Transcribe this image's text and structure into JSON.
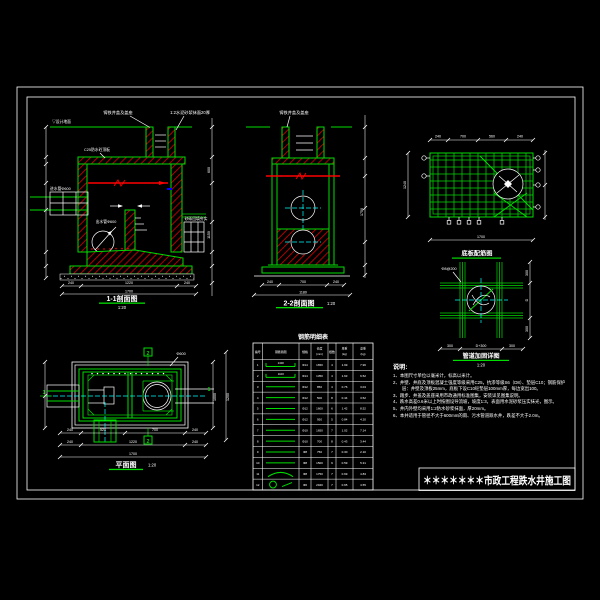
{
  "sheet": {
    "background": "#000000",
    "frame_color": "#ffffff",
    "line_green": "#00dd00",
    "line_red": "#ff0000",
    "line_cyan": "#00ffff",
    "accent_blue": "#0000ff"
  },
  "title_block": {
    "title": "＊＊＊＊＊＊＊市政工程跌水井施工图"
  },
  "views": {
    "section11": {
      "label": "1-1剖面图",
      "scale": "1:20",
      "ann_cover": "铸铁井盖及盖座",
      "ann_plaster": "1:2水泥砂浆抹面20厚",
      "ann_slab": "C25防水砼顶板",
      "ann_ground": "▽设计地面",
      "ann_inlet": "进水管Φ600",
      "ann_outlet": "出水管Φ600",
      "ann_backfill": "砂砾回填夯实",
      "dims_bottom": [
        "240",
        "1220",
        "240"
      ],
      "dim_overall": "1700",
      "dims_right": [
        "600",
        "1150"
      ]
    },
    "section22": {
      "label": "2-2剖面图",
      "scale": "1:20",
      "ann_cover": "铸铁井盖及盖座",
      "dims_bottom": [
        "240",
        "700",
        "240"
      ],
      "dim_overall": "1180",
      "dim_right": "1750"
    },
    "rebarPlan": {
      "label": "底板配筋图",
      "dims_top": [
        "240",
        "700",
        "560",
        "240"
      ],
      "dim_left": "1240",
      "dim_bottom": "1700"
    },
    "pipeDetail": {
      "label": "管道加固详图",
      "scale": "1:20",
      "ann_bar": "Φ8@200",
      "dims_bottom": [
        "300",
        "D+300",
        "300"
      ],
      "dims_right": [
        "300",
        "D",
        "300"
      ]
    },
    "plan": {
      "label": "平面图",
      "scale": "1:20",
      "marker_h": "1",
      "marker_v": "2",
      "ann_pipe": "Φ600",
      "dims_row1": [
        "240",
        "520",
        "700",
        "240"
      ],
      "dims_row2": [
        "240",
        "1220",
        "240"
      ],
      "dim_overall": "1700",
      "dims_right": [
        "1000",
        "1200"
      ]
    }
  },
  "rebar_table": {
    "title": "钢筋明细表",
    "headers": [
      "编号",
      "钢筋简图",
      "规格",
      "长度(mm)",
      "根数",
      "单重(kg)",
      "总重(kg)"
    ],
    "rows": [
      {
        "no": "1",
        "shape": "hook",
        "shape_label": "1400",
        "spec": "Φ14",
        "len": "1650",
        "qty": "4",
        "unit": "1.99",
        "total": "7.96"
      },
      {
        "no": "2",
        "shape": "hook",
        "shape_label": "1100",
        "spec": "Φ14",
        "len": "1350",
        "qty": "4",
        "unit": "1.63",
        "total": "6.52"
      },
      {
        "no": "3",
        "shape": "line",
        "shape_label": "",
        "spec": "Φ12",
        "len": "850",
        "qty": "4",
        "unit": "0.76",
        "total": "3.04"
      },
      {
        "no": "4",
        "shape": "line",
        "shape_label": "",
        "spec": "Φ12",
        "len": "500",
        "qty": "8",
        "unit": "0.44",
        "total": "3.52"
      },
      {
        "no": "5",
        "shape": "line",
        "shape_label": "",
        "spec": "Φ12",
        "len": "1600",
        "qty": "6",
        "unit": "1.42",
        "total": "8.52"
      },
      {
        "no": "6",
        "shape": "line",
        "shape_label": "",
        "spec": "Φ12",
        "len": "950",
        "qty": "5",
        "unit": "0.84",
        "total": "4.20"
      },
      {
        "no": "7",
        "shape": "line",
        "shape_label": "",
        "spec": "Φ10",
        "len": "1650",
        "qty": "7",
        "unit": "1.02",
        "total": "7.14"
      },
      {
        "no": "8",
        "shape": "line",
        "shape_label": "",
        "spec": "Φ10",
        "len": "700",
        "qty": "8",
        "unit": "0.43",
        "total": "3.44"
      },
      {
        "no": "9",
        "shape": "line",
        "shape_label": "",
        "spec": "Φ8",
        "len": "750",
        "qty": "7",
        "unit": "0.30",
        "total": "2.10"
      },
      {
        "no": "10",
        "shape": "line",
        "shape_label": "",
        "spec": "Φ8",
        "len": "1500",
        "qty": "9",
        "unit": "0.59",
        "total": "5.31"
      },
      {
        "no": "11",
        "shape": "arc",
        "shape_label": "",
        "spec": "Φ8",
        "len": "1750",
        "qty": "7",
        "unit": "0.69",
        "total": "4.83"
      },
      {
        "no": "12",
        "shape": "ring",
        "shape_label": "",
        "spec": "Φ6",
        "len": "2940",
        "qty": "7",
        "unit": "0.65",
        "total": "4.55"
      }
    ]
  },
  "notes": {
    "heading": "说明:",
    "items": [
      "本图尺寸单位以毫米计，标高以米计。",
      "井壁、井底及顶板混凝土强度等级采用C25，抗渗等级S6（D8）、垫层C10；钢筋保护层：井壁及顶板25mm，底板下设C10砼垫层100mm厚，每边宽出100。",
      "踏步、井盖及盖座采用市政通用标准图集，安装详见图集说明。",
      "跌水高差0.6米以上时按图设导流坡，坡度1:3，表面用水泥砂浆压实抹光，图示。",
      "井内外壁均采用1:2防水砂浆抹面，厚20mm。",
      "本井适用于管径不大于600mm的雨、污水管道跌水井，跌差不大于2.0m。"
    ]
  }
}
